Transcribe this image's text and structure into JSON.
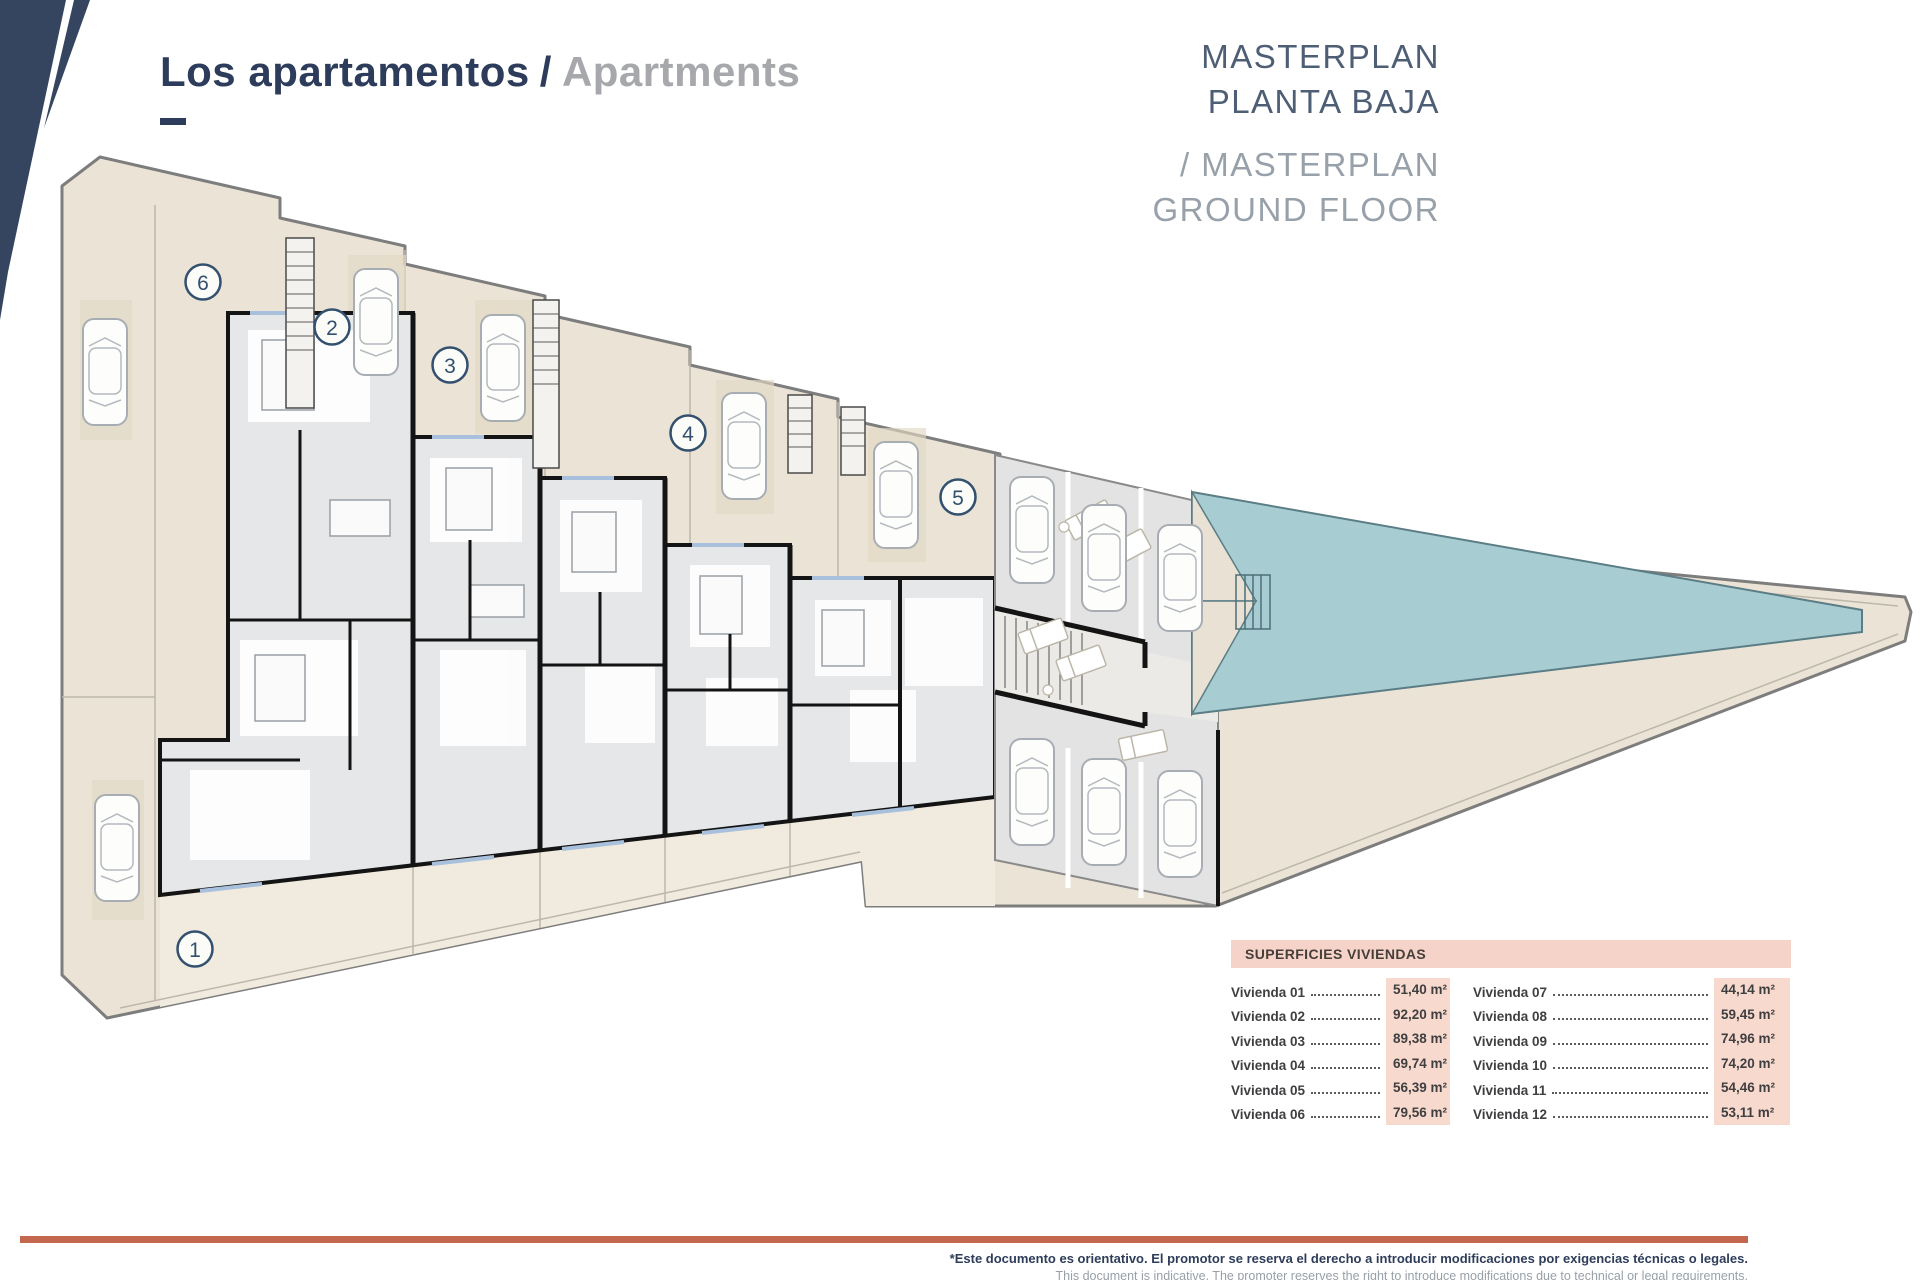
{
  "header": {
    "title_primary": "Los apartamentos",
    "title_separator": "/",
    "title_secondary": "Apartments"
  },
  "masterplan_label": {
    "line1": "MASTERPLAN",
    "line2": "PLANTA BAJA",
    "line3": "/ MASTERPLAN",
    "line4": "GROUND FLOOR"
  },
  "plan": {
    "units": {
      "u1": "1",
      "u2": "2",
      "u3": "3",
      "u4": "4",
      "u5": "5",
      "u6": "6"
    }
  },
  "areas_table": {
    "title": "SUPERFICIES VIVIENDAS",
    "left_rows": [
      {
        "label": "Vivienda 01",
        "value": "51,40 m²"
      },
      {
        "label": "Vivienda 02",
        "value": "92,20 m²"
      },
      {
        "label": "Vivienda 03",
        "value": "89,38 m²"
      },
      {
        "label": "Vivienda 04",
        "value": "69,74 m²"
      },
      {
        "label": "Vivienda 05",
        "value": "56,39 m²"
      },
      {
        "label": "Vivienda 06",
        "value": "79,56 m²"
      }
    ],
    "right_rows": [
      {
        "label": "Vivienda 07",
        "value": "44,14 m²"
      },
      {
        "label": "Vivienda 08",
        "value": "59,45 m²"
      },
      {
        "label": "Vivienda 09",
        "value": "74,96 m²"
      },
      {
        "label": "Vivienda 10",
        "value": "74,20 m²"
      },
      {
        "label": "Vivienda 11",
        "value": "54,46 m²"
      },
      {
        "label": "Vivienda 12",
        "value": "53,11 m²"
      }
    ]
  },
  "footer": {
    "disclaimer_primary": "*Este documento es orientativo. El promotor se reserva el derecho a introducir modificaciones por exigencias técnicas o legales.",
    "disclaimer_secondary": "This document is indicative. The promoter reserves the right to introduce modifications due to technical or legal requirements."
  },
  "colors": {
    "navy": "#2d3c5a",
    "muted_gray": "#a6a8ab",
    "terracotta": "#c4674f",
    "table_pink": "#f6d3c8",
    "value_pink": "#f8d9cd",
    "pool_teal": "#a7ccd1",
    "terrace_beige": "#ebe4d6",
    "interior_gray": "#e6e7e9"
  }
}
